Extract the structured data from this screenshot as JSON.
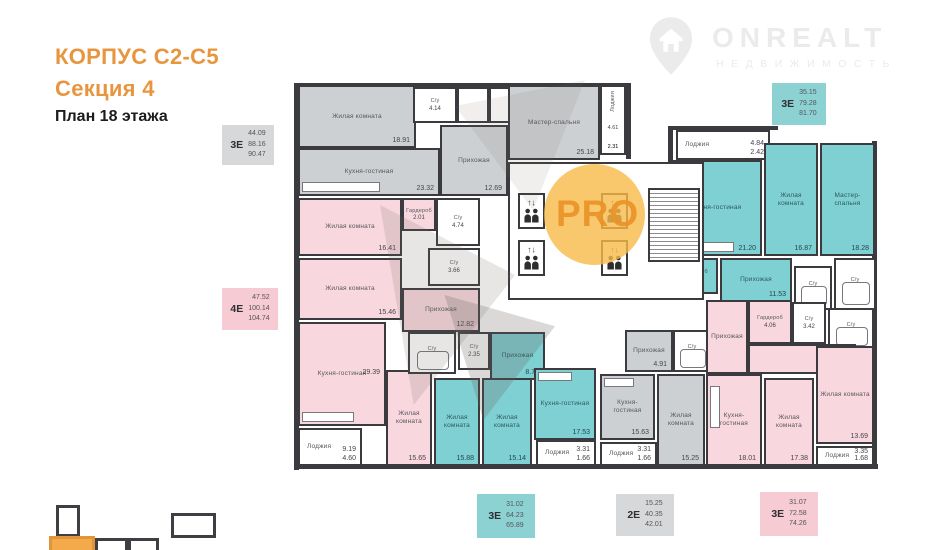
{
  "header": {
    "building": "КОРПУС С2-С5",
    "section": "Секция 4",
    "floor": "План 18 этажа"
  },
  "logo": {
    "brand": "ONREALT",
    "tagline": "НЕДВИЖИМОСТЬ"
  },
  "watermark": {
    "label": "PRO"
  },
  "colors": {
    "accent_orange": "#E8963E",
    "apartment_pink": "#F8D8DE",
    "apartment_teal": "#7FD0D3",
    "apartment_gray": "#CDD0D2",
    "wall": "#3B3B3F"
  },
  "badges": {
    "top_left": {
      "type": "3Е",
      "living": "44.09",
      "total": "88.16",
      "total_loggia": "90.47"
    },
    "mid_left": {
      "type": "4Е",
      "living": "47.52",
      "total": "100.14",
      "total_loggia": "104.74"
    },
    "top_right": {
      "type": "3Е",
      "living": "35.15",
      "total": "79.28",
      "total_loggia": "81.70"
    },
    "bottom_teal": {
      "type": "3Е",
      "living": "31.02",
      "total": "64.23",
      "total_loggia": "65.89"
    },
    "bottom_gray": {
      "type": "2Е",
      "living": "15.25",
      "total": "40.35",
      "total_loggia": "42.01"
    },
    "bottom_pink": {
      "type": "3Е",
      "living": "31.07",
      "total": "72.58",
      "total_loggia": "74.26"
    }
  },
  "rooms": {
    "a1": {
      "label": "Жилая комната",
      "area": "18.91"
    },
    "a2": {
      "label": "Кухня-гостиная",
      "area": "23.32"
    },
    "a3": {
      "label": "С/у",
      "area": "4.14"
    },
    "a4": {
      "label": "С/у",
      "area": "3.92"
    },
    "a5": {
      "label": "Прихожая",
      "area": "12.69"
    },
    "a6": {
      "label": "Мастер-спальня",
      "area": "25.18"
    },
    "a7": {
      "label": "Лоджия",
      "area": "4.61",
      "area2": "2.31"
    },
    "b1": {
      "label": "Жилая комната",
      "area": "16.41"
    },
    "b2": {
      "label": "Гардероб",
      "area": "2.01"
    },
    "b3": {
      "label": "С/у",
      "area": "4.74"
    },
    "b4": {
      "label": "Жилая комната",
      "area": "15.46"
    },
    "b5": {
      "label": "С/у",
      "area": "3.66"
    },
    "b6": {
      "label": "Прихожая",
      "area": "12.82"
    },
    "b7": {
      "label": "Кухня-гостиная",
      "area": "29.39"
    },
    "b8": {
      "label": "Лоджия",
      "area": "9.19",
      "area2": "4.60"
    },
    "b9": {
      "label": "Жилая комната",
      "area": "15.65"
    },
    "c1": {
      "label": "Лоджия",
      "area": "4.84",
      "area2": "2.42"
    },
    "c2": {
      "label": "Кухня-гостиная",
      "area": "21.20"
    },
    "c3": {
      "label": "Жилая комната",
      "area": "16.87"
    },
    "c4": {
      "label": "Мастер-спальня",
      "area": "18.28"
    },
    "c5": {
      "label": "Гардероб",
      "area": "2.39"
    },
    "c6": {
      "label": "Прихожая",
      "area": "11.53"
    },
    "c7": {
      "label": "С/у",
      "area": "4.07"
    },
    "c8": {
      "label": "С/у",
      "area": "4.94"
    },
    "d1": {
      "label": "С/у",
      "area": "4.61"
    },
    "d2": {
      "label": "С/у",
      "area": "2.35"
    },
    "d3": {
      "label": "Прихожая",
      "area": "8.72"
    },
    "d4": {
      "label": "Жилая комната",
      "area": "15.88"
    },
    "d5": {
      "label": "Жилая комната",
      "area": "15.14"
    },
    "d6": {
      "label": "Кухня-гостиная",
      "area": "17.53"
    },
    "d7": {
      "label": "Лоджия",
      "area": "3.31",
      "area2": "1.66"
    },
    "e1": {
      "label": "Прихожая",
      "area": "4.91"
    },
    "e2": {
      "label": "С/у",
      "area": "4.56"
    },
    "e3": {
      "label": "Кухня-гостиная",
      "area": "15.63"
    },
    "e4": {
      "label": "Лоджия",
      "area": "3.31",
      "area2": "1.66"
    },
    "e5": {
      "label": "Жилая комната",
      "area": "15.25"
    },
    "f1": {
      "label": "Гардероб",
      "area": "4.06"
    },
    "f2": {
      "label": "Прихожая",
      "area": "10.40"
    },
    "f3": {
      "label": "С/у",
      "area": "3.42"
    },
    "f4": {
      "label": "С/у",
      "area": "5.62"
    },
    "f5": {
      "label": "Кухня-гостиная",
      "area": "18.01"
    },
    "f6": {
      "label": "Жилая комната",
      "area": "17.38"
    },
    "f7": {
      "label": "Жилая комната",
      "area": "13.69"
    },
    "f8": {
      "label": "Лоджия",
      "area": "3.35",
      "area2": "1.68"
    }
  }
}
